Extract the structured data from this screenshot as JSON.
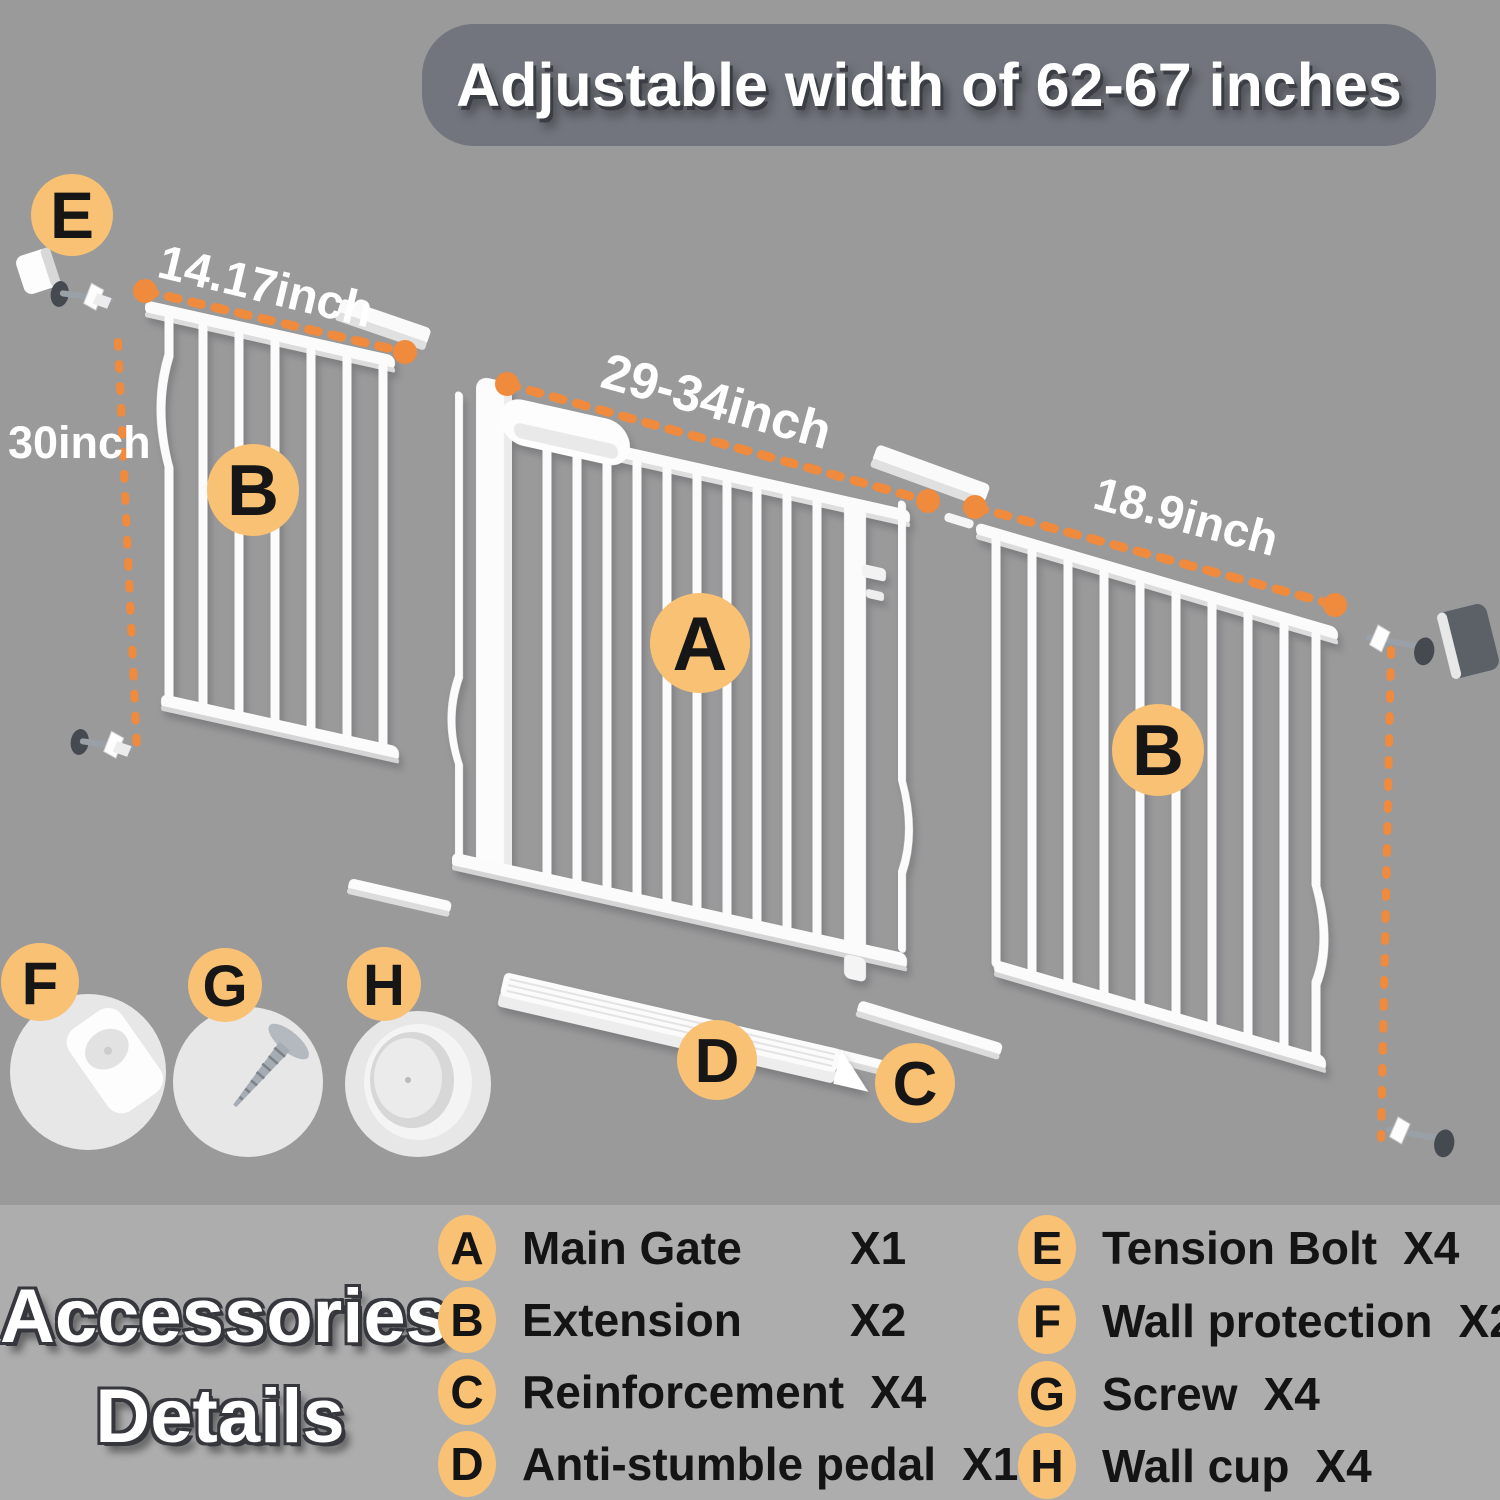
{
  "banner": {
    "title": "Adjustable width of 62-67 inches"
  },
  "diagram": {
    "dimensions": {
      "left_width": "14.17inch",
      "gate_width": "29-34inch",
      "right_width": "18.9inch",
      "height": "30inch"
    },
    "part_badges": {
      "tension_bolt": "E",
      "extension_left": "B",
      "main_gate": "A",
      "extension_right": "B",
      "wall_protection": "F",
      "screw": "G",
      "wall_cup": "H",
      "anti_stumble_pedal": "D",
      "reinforcement": "C"
    }
  },
  "legend": {
    "heading": {
      "line1": "Accessories",
      "line2": "Details"
    },
    "columns": {
      "left": [
        {
          "letter": "A",
          "label": "Main Gate",
          "count": "X1"
        },
        {
          "letter": "B",
          "label": "Extension",
          "count": "X2"
        },
        {
          "letter": "C",
          "label": "Reinforcement",
          "count": "X4"
        },
        {
          "letter": "D",
          "label": "Anti-stumble pedal",
          "count": "X1"
        }
      ],
      "right": [
        {
          "letter": "E",
          "label": "Tension Bolt",
          "count": "X4"
        },
        {
          "letter": "F",
          "label": "Wall protection",
          "count": "X2"
        },
        {
          "letter": "G",
          "label": "Screw",
          "count": "X4"
        },
        {
          "letter": "H",
          "label": "Wall cup",
          "count": "X4"
        }
      ]
    }
  },
  "colors": {
    "background": "#9A9A9B",
    "legend_background": "#AEADAE",
    "banner_background": "#72757D",
    "badge_orange": "#F8C173",
    "dimension_orange": "#F08A3D",
    "gate_white": "#FBFBFB",
    "text_dark": "#141414",
    "text_white": "#FFFFFF"
  }
}
